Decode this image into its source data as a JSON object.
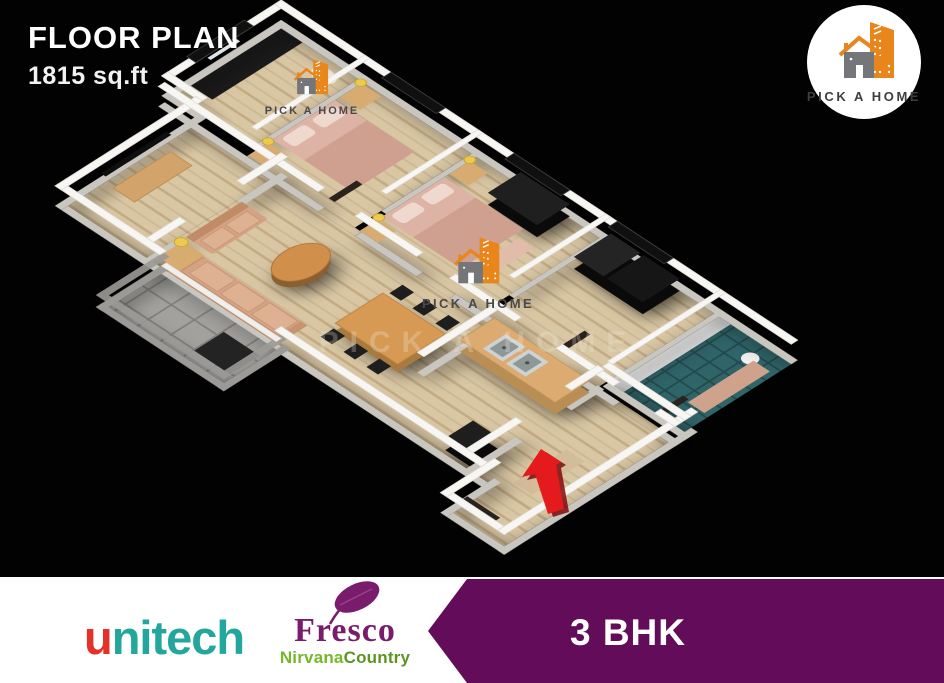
{
  "header": {
    "title": "FLOOR PLAN",
    "area": "1815 sq.ft"
  },
  "brand_badge": {
    "name": "PICK A HOME"
  },
  "decals": {
    "wall_text": "PICK A HOME",
    "floor_watermark": "PICK A HOME"
  },
  "footer": {
    "bhk": "3 BHK",
    "unitech": {
      "first": "u",
      "rest": "nitech"
    },
    "fresco": {
      "name": "Fresco",
      "sub1": "Nirvana",
      "sub2": "Country"
    }
  },
  "colors": {
    "banner_purple": "#630c59",
    "logo_orange": "#e8861c",
    "logo_gray": "#75767a",
    "unitech_red": "#e53228",
    "unitech_teal": "#23a79c",
    "fresco_purple": "#7a1c6c",
    "nirvana_green": "#76b82a",
    "country_green": "#5d9422",
    "entrance_arrow_red": "#e51a1c",
    "wood_floor": "#d7c5a2",
    "wall_white": "#f7f6f3"
  }
}
